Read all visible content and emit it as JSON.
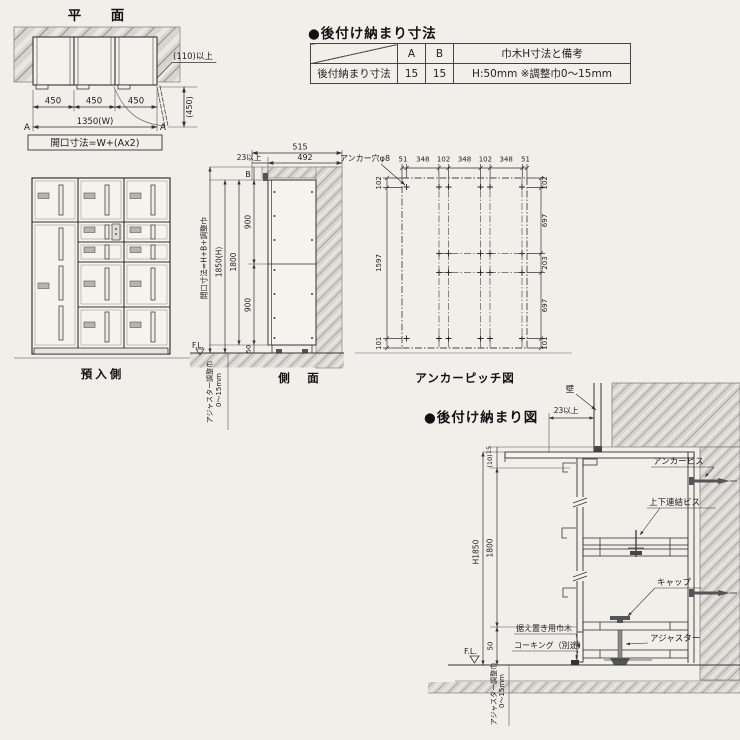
{
  "plan": {
    "title": "平　面",
    "dims": [
      "450",
      "450",
      "450"
    ],
    "total": "1350(W)",
    "opening": "開口寸法=W+(Ax2)",
    "a_left": "A",
    "a_right": "A",
    "depth": "(450)",
    "clearance": "(110)以上"
  },
  "spec_table": {
    "title": "●後付け納まり寸法",
    "col_a": "A",
    "col_b": "B",
    "col_remark": "巾木H寸法と備考",
    "row_label": "後付納まり寸法",
    "val_a": "15",
    "val_b": "15",
    "val_remark": "H:50mm ※調整巾0〜15mm"
  },
  "elevation": {
    "caption": "預入側"
  },
  "side": {
    "caption": "側　面",
    "d515": "515",
    "d492": "492",
    "gap": "23以上",
    "b": "B",
    "d900a": "900",
    "d900b": "900",
    "d50": "50",
    "d1800": "1800",
    "d1850": "1850(H)",
    "opening": "開口寸法=H+B+調整巾",
    "fl": "F.L.",
    "adj1": "アジャスター調整巾",
    "adj2": "0〜15mm"
  },
  "anchor": {
    "caption": "アンカーピッチ図",
    "hole": "アンカー穴φ8",
    "top": [
      "51",
      "348",
      "102",
      "348",
      "102",
      "348",
      "51"
    ],
    "left": [
      "102",
      "1597",
      "101"
    ],
    "right": [
      "102",
      "697",
      "203",
      "697",
      "101"
    ]
  },
  "detail": {
    "title": "●後付け納まり図",
    "wall": "壁",
    "gap": "23以上",
    "d15": "15",
    "d10": "(10)",
    "d1800": "1800",
    "h1850": "H1850",
    "d50": "50",
    "fl": "F.L.",
    "anchor_screw": "アンカービス",
    "join_screw": "上下連結ビス",
    "cap": "キャップ",
    "adjuster": "アジャスター",
    "base": "据え置き用巾木",
    "caulk": "コーキング（別途）",
    "adj1": "アジャスター調整巾",
    "adj2": "0〜15mm"
  }
}
